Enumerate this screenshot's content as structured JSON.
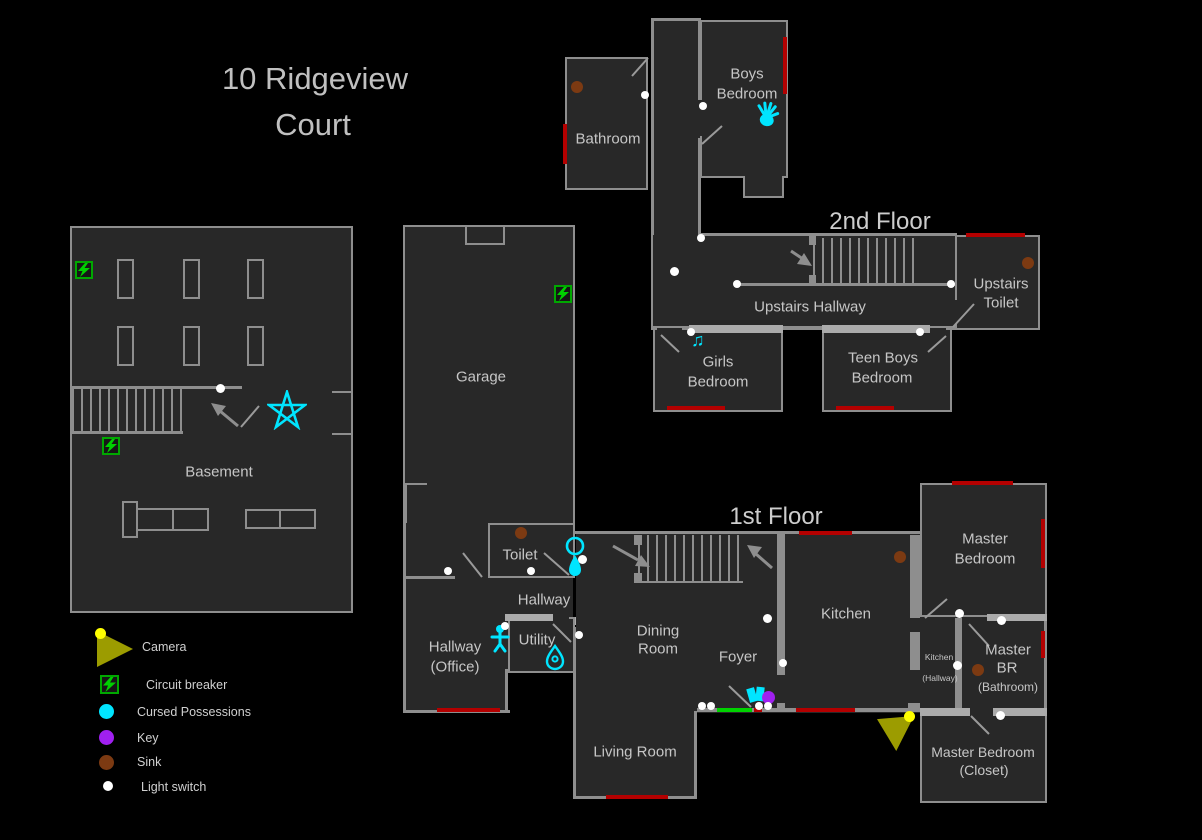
{
  "title": {
    "line1": "10 Ridgeview",
    "line2": "Court"
  },
  "floor_labels": {
    "second": "2nd Floor",
    "first": "1st Floor"
  },
  "rooms": {
    "basement": "Basement",
    "garage": "Garage",
    "bathroom_2f": "Bathroom",
    "boys_bedroom_l1": "Boys",
    "boys_bedroom_l2": "Bedroom",
    "upstairs_hallway": "Upstairs Hallway",
    "upstairs_toilet_l1": "Upstairs",
    "upstairs_toilet_l2": "Toilet",
    "girls_bedroom_l1": "Girls",
    "girls_bedroom_l2": "Bedroom",
    "teen_boys_bedroom_l1": "Teen Boys",
    "teen_boys_bedroom_l2": "Bedroom",
    "toilet": "Toilet",
    "hallway": "Hallway",
    "hallway_office_l1": "Hallway",
    "hallway_office_l2": "(Office)",
    "utility": "Utility",
    "dining_room_l1": "Dining",
    "dining_room_l2": "Room",
    "foyer": "Foyer",
    "living_room": "Living Room",
    "kitchen": "Kitchen",
    "master_bedroom_l1": "Master",
    "master_bedroom_l2": "Bedroom",
    "kitchen_hallway_l1": "Kitchen",
    "kitchen_hallway_l2": "(Hallway)",
    "master_br_l1": "Master",
    "master_br_l2": "BR",
    "master_br_l3": "(Bathroom)",
    "closet_l1": "Master Bedroom",
    "closet_l2": "(Closet)"
  },
  "legend": [
    {
      "label": "Camera",
      "icon": "camera"
    },
    {
      "label": "Circuit breaker",
      "icon": "circuit-breaker"
    },
    {
      "label": "Cursed Possessions",
      "icon": "cursed-possessions"
    },
    {
      "label": "Key",
      "icon": "key"
    },
    {
      "label": "Sink",
      "icon": "sink"
    },
    {
      "label": "Light switch",
      "icon": "light-switch"
    }
  ],
  "colors": {
    "cursed_possession": "#00e5ff",
    "key": "#a020f0",
    "sink": "#8b4513",
    "light_switch": "#ffffff",
    "window_marker": "#b40000",
    "entry_door": "#00d200",
    "camera": "#9c9c00",
    "camera_dot": "#ffff00",
    "circuit_breaker": "#00cc00",
    "wall": "#8e8e8e",
    "room_fill": "#282828",
    "text": "#c6c6c6"
  }
}
